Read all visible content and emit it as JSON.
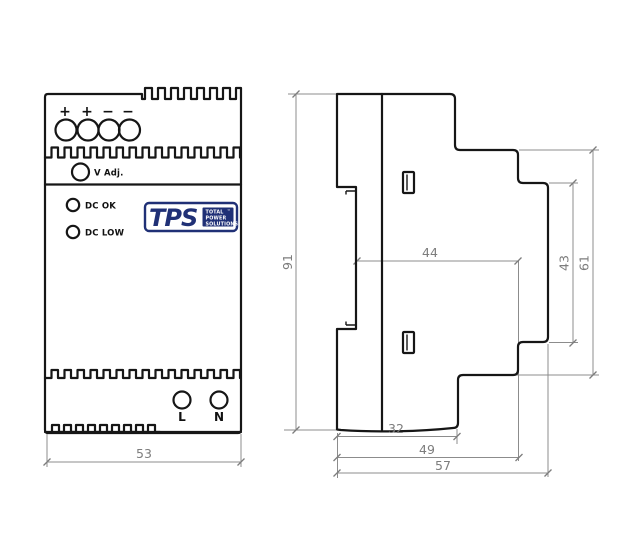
{
  "front_view": {
    "input_terminal_labels": [
      "+",
      "+",
      "−",
      "−"
    ],
    "v_adj": "V  Adj.",
    "led_dc_ok": "DC OK",
    "led_dc_low": "DC LOW",
    "terminal_l": "L",
    "terminal_n": "N",
    "logo": {
      "acronym": "TPS",
      "line1": "TOTAL",
      "line2": "POWER",
      "line3": "SOLUTIONS",
      "trademark": "™"
    },
    "dim_width": "53"
  },
  "side_view": {
    "dims": {
      "height": "91",
      "body": "44",
      "step": "43",
      "upper_depth": "61",
      "front": "32",
      "mid": "49",
      "total": "57"
    }
  },
  "colors": {
    "line": "#161616",
    "dimension": "#8c8c8c",
    "logo_blue": "#203076"
  }
}
